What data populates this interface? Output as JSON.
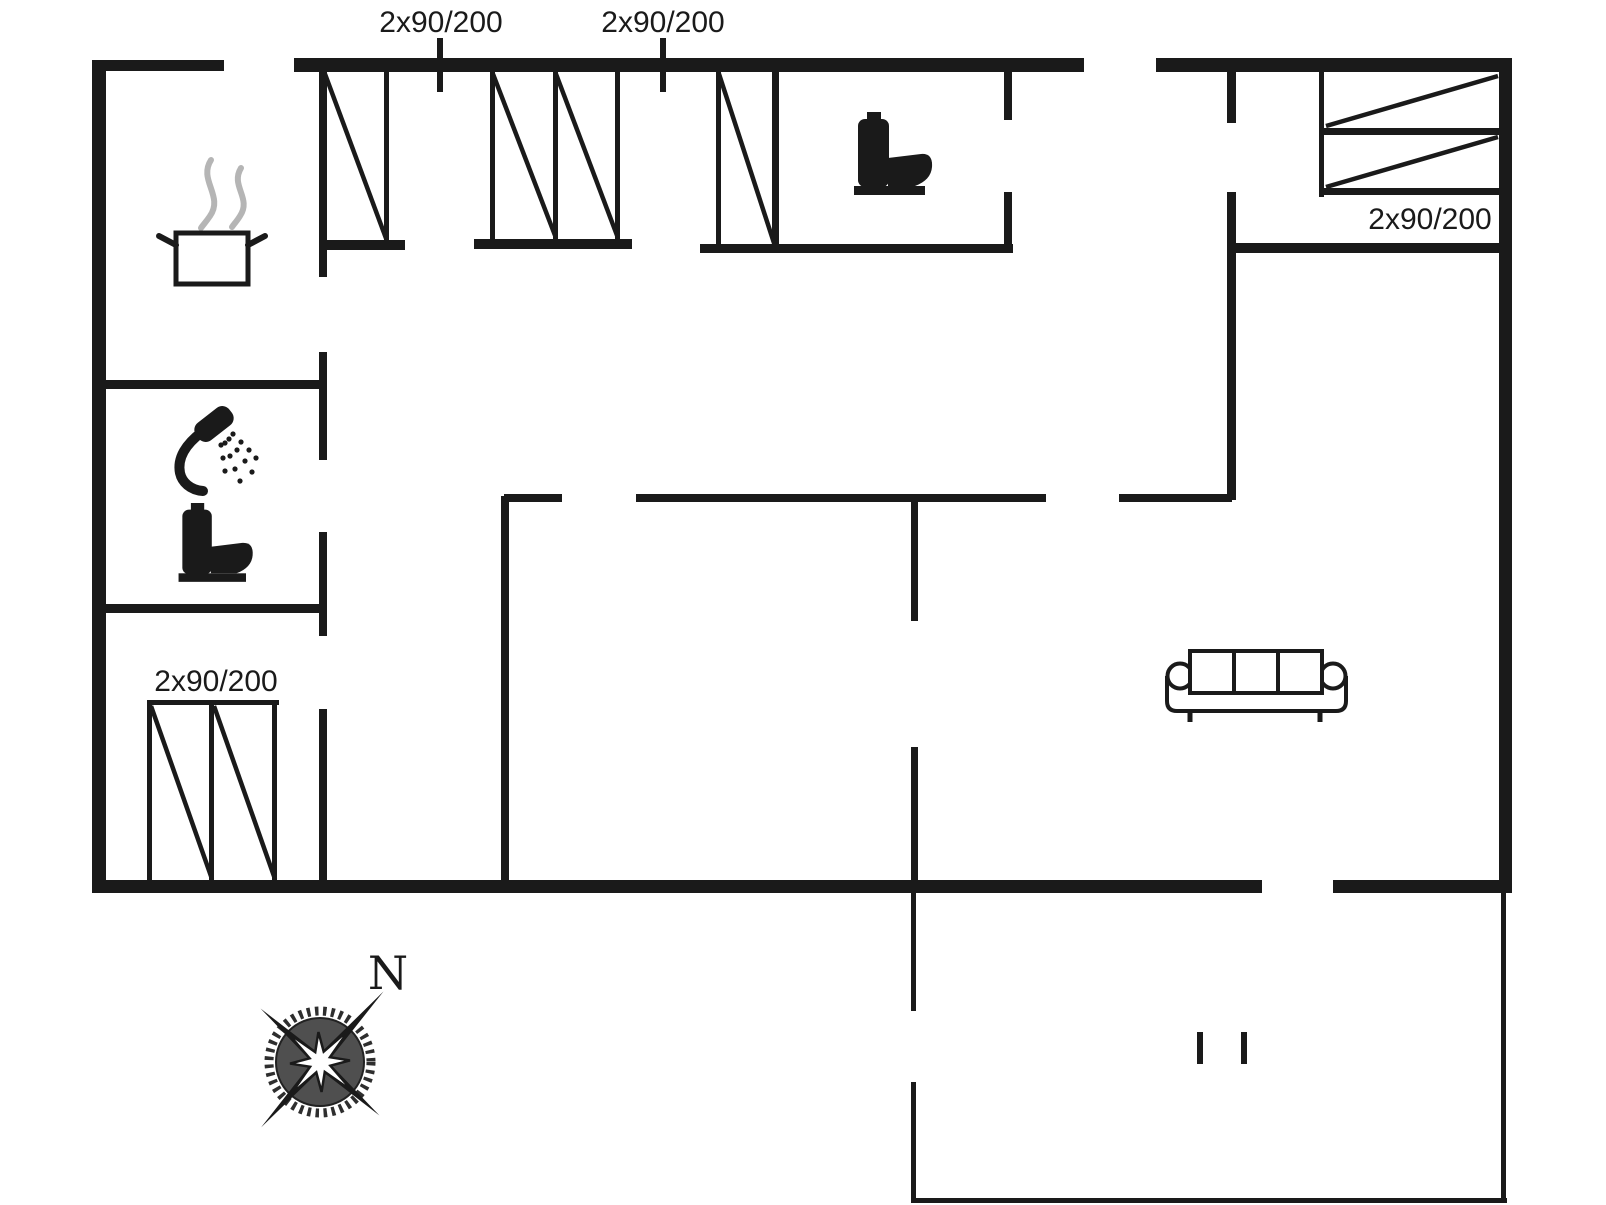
{
  "colors": {
    "ink": "#1a1a1a",
    "paper": "#ffffff",
    "steam": "#b5b5b5",
    "compass-disc": "#4f4f4f"
  },
  "labels": {
    "bed_top_left": "2x90/200",
    "bed_top_center": "2x90/200",
    "bed_right": "2x90/200",
    "bed_bottom_left": "2x90/200"
  },
  "compass": {
    "north": "N"
  },
  "icons": {
    "stove": "cooking-pot-with-steam",
    "wc": "toilet",
    "bathroom": "shower-and-toilet",
    "living": "three-seat-sofa",
    "orientation": "compass-rose"
  }
}
